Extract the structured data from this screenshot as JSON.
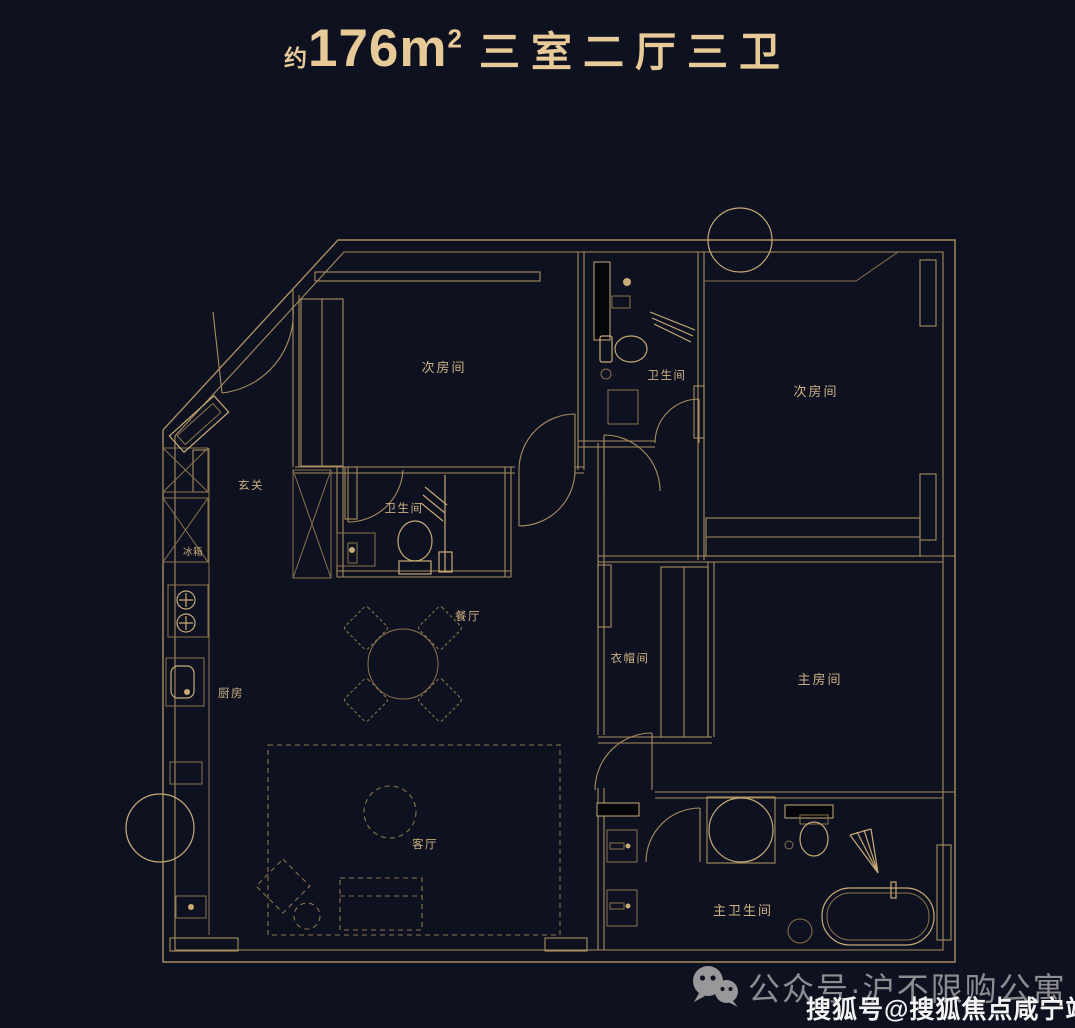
{
  "title": {
    "approx": "约",
    "area": "176m",
    "area_sup": "2",
    "rooms": "三室二厅三卫"
  },
  "plan": {
    "labels": {
      "bedroom_top_left": "次房间",
      "bath_top": "卫生间",
      "bedroom_top_right": "次房间",
      "entry": "玄关",
      "bath_mid": "卫生间",
      "dining": "餐厅",
      "closet": "衣帽间",
      "master_bedroom": "主房间",
      "kitchen": "厨房",
      "living": "客厅",
      "master_bath": "主卫生间",
      "fridge": "冰箱"
    }
  },
  "watermark": {
    "wechat_account": "公众号·沪不限购公寓",
    "sohu_account": "搜狐号@搜狐焦点咸宁站"
  },
  "colors": {
    "background": "#0e1120",
    "line": "#a88e5e",
    "lineBright": "#c9ab77",
    "lineDim": "#8a744c",
    "label": "#cdb183",
    "accent": "#e7ca97",
    "watermarkGray": "#98989b",
    "watermarkWhite": "#f4f4f4"
  }
}
